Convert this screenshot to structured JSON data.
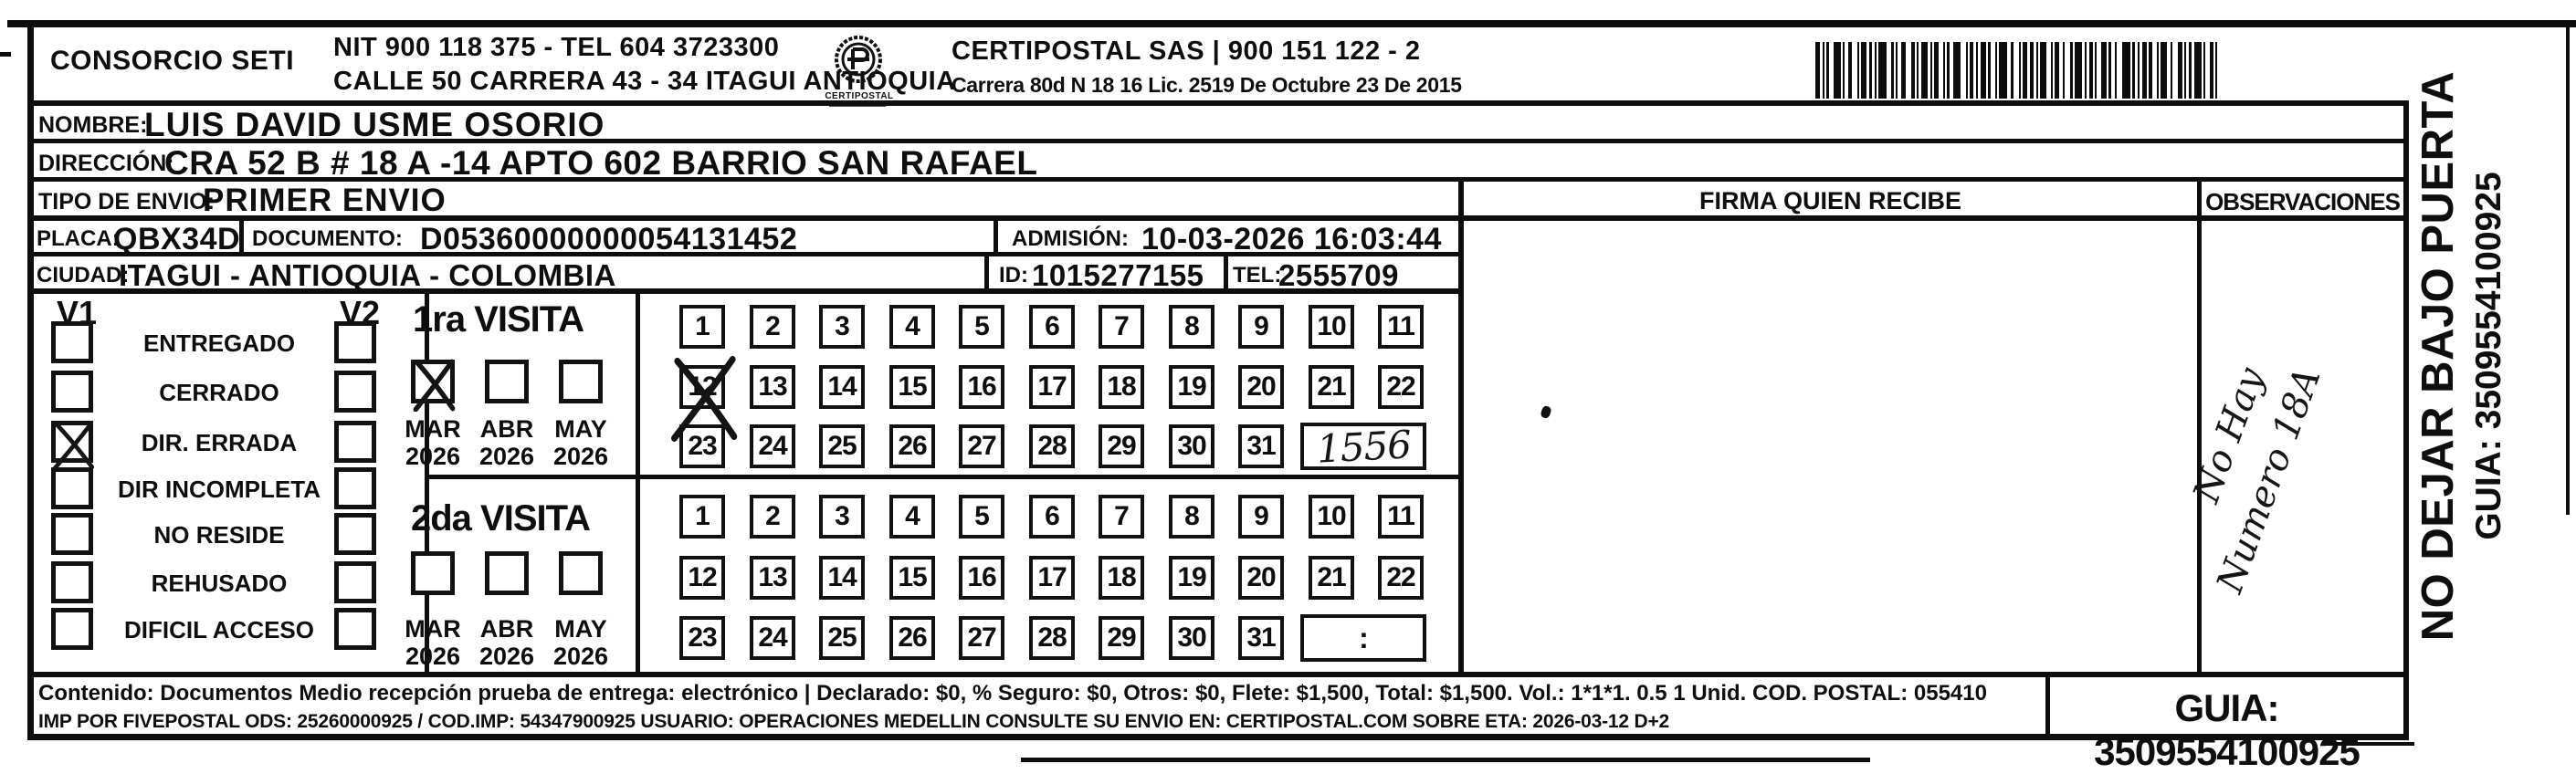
{
  "header": {
    "company": "CONSORCIO SETI",
    "nit_tel": "NIT 900 118 375 - TEL 604 3723300",
    "street": "CALLE 50 CARRERA 43 - 34 ITAGUI ANTIOQUIA",
    "logo_caption": "CERTIPOSTAL",
    "operator": "CERTIPOSTAL SAS | 900 151 122 - 2",
    "license": "Carrera 80d N 18 16  Lic. 2519 De Octubre 23 De 2015"
  },
  "shipment": {
    "nombre": {
      "label": "NOMBRE:",
      "value": "LUIS DAVID USME OSORIO"
    },
    "direccion": {
      "label": "DIRECCIÓN:",
      "value": "CRA 52 B # 18 A -14 APTO 602 BARRIO SAN RAFAEL"
    },
    "tipo_envio": {
      "label": "TIPO DE ENVIO:",
      "value": "PRIMER ENVIO"
    },
    "placa": {
      "label": "PLACA:",
      "value": "QBX34D"
    },
    "documento": {
      "label": "DOCUMENTO:",
      "value": "D05360000000054131452"
    },
    "admision": {
      "label": "ADMISIÓN:",
      "value": "10-03-2026 16:03:44"
    },
    "ciudad": {
      "label": "CIUDAD:",
      "value": "ITAGUI - ANTIOQUIA - COLOMBIA"
    },
    "id": {
      "label": "ID:",
      "value": "1015277155"
    },
    "tel": {
      "label": "TEL:",
      "value": "2555709"
    }
  },
  "status_panel": {
    "v1_header": "V1",
    "v2_header": "V2",
    "items": [
      {
        "label": "ENTREGADO",
        "v1_checked": false,
        "v2_checked": false
      },
      {
        "label": "CERRADO",
        "v1_checked": false,
        "v2_checked": false
      },
      {
        "label": "DIR. ERRADA",
        "v1_checked": true,
        "v2_checked": false
      },
      {
        "label": "DIR INCOMPLETA",
        "v1_checked": false,
        "v2_checked": false
      },
      {
        "label": "NO RESIDE",
        "v1_checked": false,
        "v2_checked": false
      },
      {
        "label": "REHUSADO",
        "v1_checked": false,
        "v2_checked": false
      },
      {
        "label": "DIFICIL ACCESO",
        "v1_checked": false,
        "v2_checked": false
      }
    ]
  },
  "visits": [
    {
      "title": "1ra VISITA",
      "months": [
        {
          "month": "MAR",
          "year": "2026",
          "checked": true
        },
        {
          "month": "ABR",
          "year": "2026",
          "checked": false
        },
        {
          "month": "MAY",
          "year": "2026",
          "checked": false
        }
      ],
      "day_rows": [
        [
          1,
          2,
          3,
          4,
          5,
          6,
          7,
          8,
          9,
          10,
          11
        ],
        [
          12,
          13,
          14,
          15,
          16,
          17,
          18,
          19,
          20,
          21,
          22
        ],
        [
          23,
          24,
          25,
          26,
          27,
          28,
          29,
          30,
          31
        ]
      ],
      "crossed_days": [
        12
      ],
      "time_box": "1556",
      "time_handwritten": true
    },
    {
      "title": "2da VISITA",
      "months": [
        {
          "month": "MAR",
          "year": "2026",
          "checked": false
        },
        {
          "month": "ABR",
          "year": "2026",
          "checked": false
        },
        {
          "month": "MAY",
          "year": "2026",
          "checked": false
        }
      ],
      "day_rows": [
        [
          1,
          2,
          3,
          4,
          5,
          6,
          7,
          8,
          9,
          10,
          11
        ],
        [
          12,
          13,
          14,
          15,
          16,
          17,
          18,
          19,
          20,
          21,
          22
        ],
        [
          23,
          24,
          25,
          26,
          27,
          28,
          29,
          30,
          31
        ]
      ],
      "crossed_days": [],
      "time_box": ":",
      "time_handwritten": false
    }
  ],
  "firma": {
    "header": "FIRMA QUIEN RECIBE"
  },
  "observaciones": {
    "header": "OBSERVACIONES",
    "note_line1": "No Hay",
    "note_line2": "Numero 18A"
  },
  "side_note": {
    "line1": "NO DEJAR BAJO PUERTA",
    "line2": "GUIA: 3509554100925"
  },
  "footer": {
    "line1": "Contenido: Documentos Medio recepción prueba de entrega: electrónico | Declarado: $0, % Seguro: $0, Otros: $0, Flete: $1,500, Total: $1,500. Vol.: 1*1*1. 0.5  1 Unid. COD. POSTAL: 055410",
    "line2": "IMP POR FIVEPOSTAL ODS: 25260000925 / COD.IMP: 54347900925 USUARIO: OPERACIONES MEDELLIN CONSULTE SU ENVIO EN: CERTIPOSTAL.COM SOBRE ETA: 2026-03-12 D+2",
    "guia": "GUIA: 3509554100925"
  }
}
